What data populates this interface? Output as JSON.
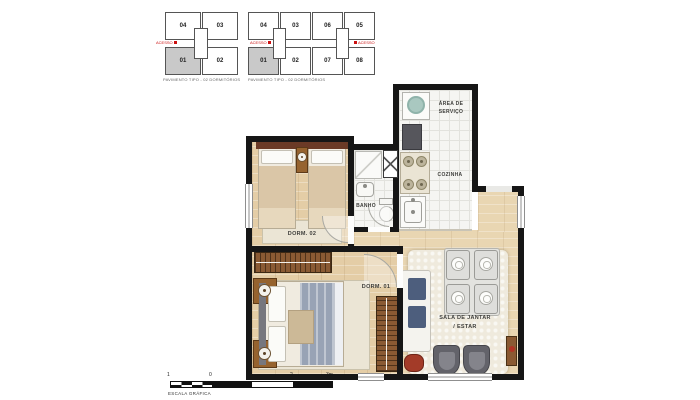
{
  "key_plans": [
    {
      "caption": "PAVIMENTO TIPO - 02 DORMITÓRIOS",
      "access_left": "ACESSO",
      "units_top": [
        "04",
        "03"
      ],
      "units_bottom": [
        "01",
        "02"
      ],
      "highlighted_unit": "01"
    },
    {
      "caption": "PAVIMENTO TIPO - 02 DORMITÓRIOS",
      "access_left": "ACESSO",
      "access_right": "ACESSO",
      "units_top": [
        "04",
        "03",
        "06",
        "05"
      ],
      "units_bottom": [
        "01",
        "02",
        "07",
        "08"
      ],
      "highlighted_unit": "01"
    }
  ],
  "rooms": {
    "area_servico_line1": "ÁREA DE",
    "area_servico_line2": "SERVIÇO",
    "cozinha": "COZINHA",
    "banho": "BANHO",
    "dorm02": "DORM. 02",
    "dorm01": "DORM. 01",
    "sala_line1": "SALA DE JANTAR",
    "sala_line2": "/ ESTAR"
  },
  "scale_bar": {
    "ticks": [
      "1",
      "0",
      "1",
      "2",
      "3m"
    ],
    "label": "ESCALA GRÁFICA"
  },
  "colors": {
    "wall": "#161616",
    "wood_floor": "#e4cda6",
    "tile_floor": "#f5f5f2",
    "highlighted_unit_fill": "#c9c9c9",
    "accent_red": "#cc1111",
    "wardrobe_wood": "#8a5a33"
  }
}
